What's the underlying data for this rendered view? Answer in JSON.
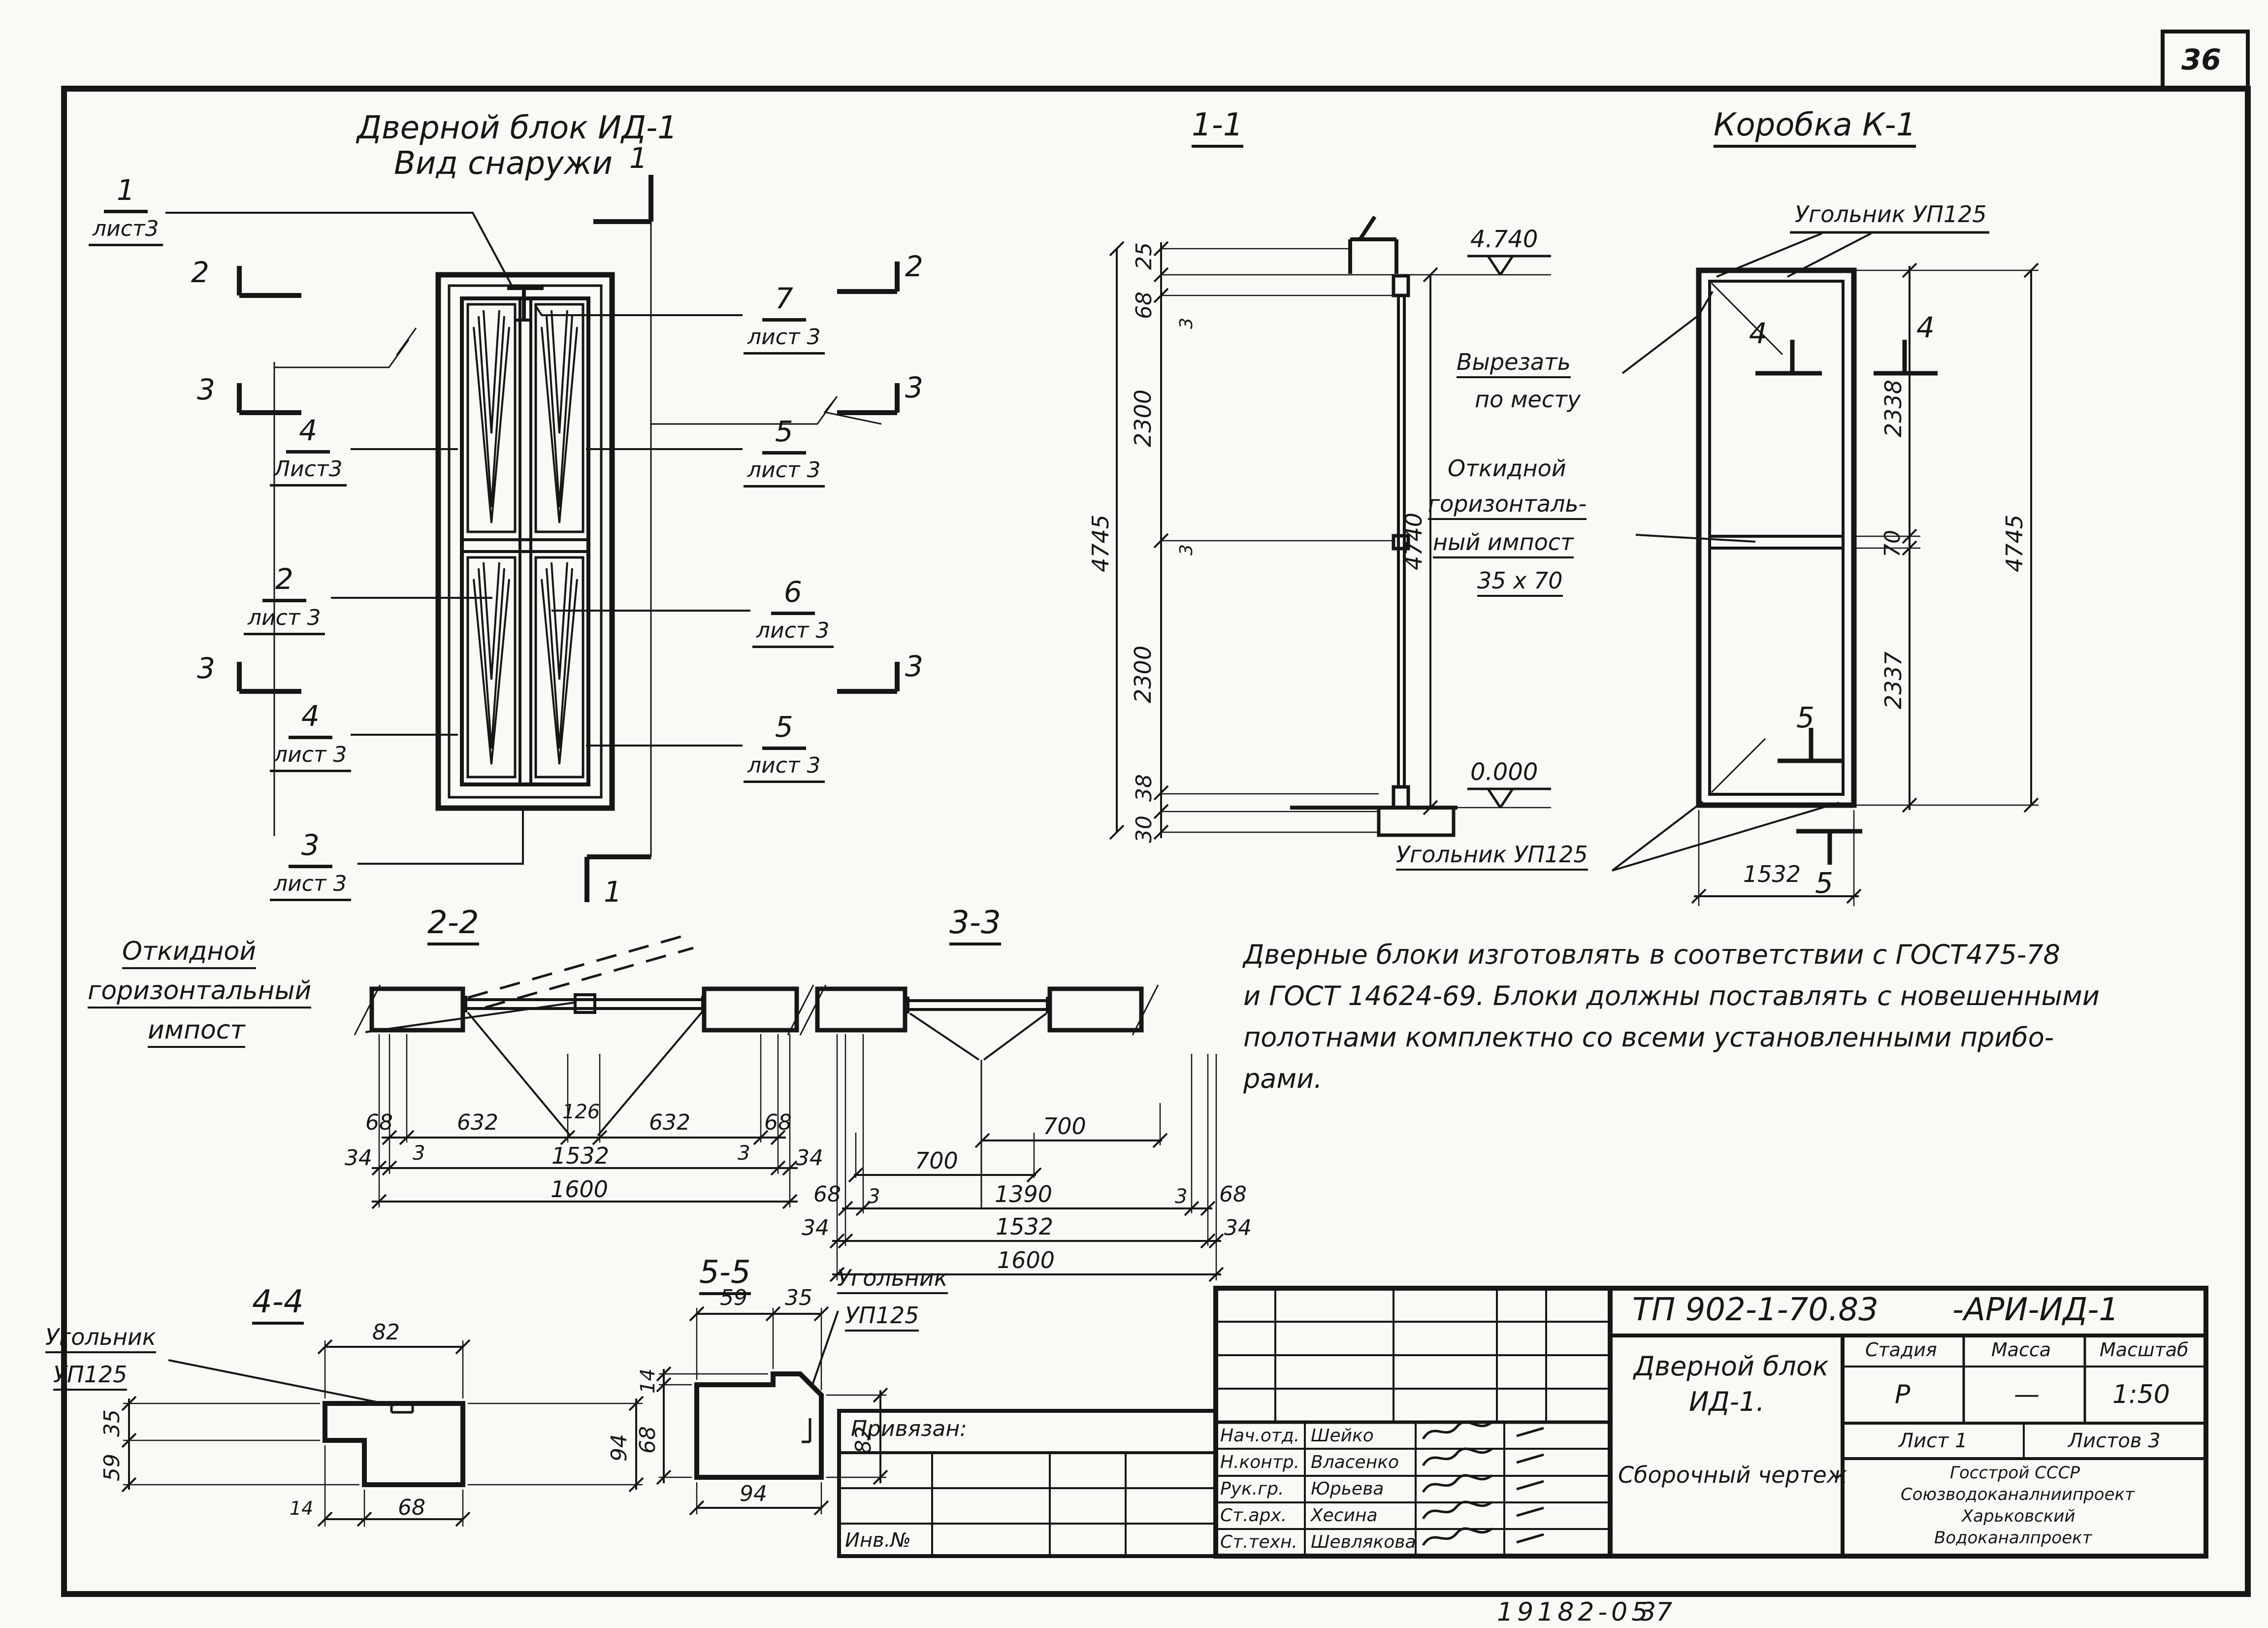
{
  "sheet": {
    "corner_number": "36",
    "footer_code": "19182-05",
    "footer_sheet": "37"
  },
  "elevation_view": {
    "title_line1": "Дверной блок ИД-1",
    "title_line2": "Вид снаружи",
    "callout_1": {
      "num": "1",
      "sheet": "лист3"
    },
    "callout_7": {
      "num": "7",
      "sheet": "лист 3"
    },
    "callout_4a": {
      "num": "4",
      "sheet": "Лист3"
    },
    "callout_5a": {
      "num": "5",
      "sheet": "лист 3"
    },
    "callout_2": {
      "num": "2",
      "sheet": "лист 3"
    },
    "callout_6": {
      "num": "6",
      "sheet": "лист 3"
    },
    "callout_4b": {
      "num": "4",
      "sheet": "лист 3"
    },
    "callout_5b": {
      "num": "5",
      "sheet": "лист 3"
    },
    "callout_3": {
      "num": "3",
      "sheet": "лист 3"
    },
    "marker_1_top": "1",
    "marker_1_bottom": "1",
    "marker_2_left": "2",
    "marker_2_right": "2",
    "marker_3_left_a": "3",
    "marker_3_right_a": "3",
    "marker_3_left_b": "3",
    "marker_3_right_b": "3"
  },
  "section_1_1": {
    "title": "1-1",
    "elev_top": "4.740",
    "elev_bottom": "0.000",
    "dim_25": "25",
    "dim_68": "68",
    "dim_3a": "3",
    "dim_2300a": "2300",
    "dim_3b": "3",
    "dim_2300b": "2300",
    "dim_38": "38",
    "dim_30": "30",
    "total_left": "4745",
    "total_right": "4740"
  },
  "korobka_view": {
    "title": "Коробка К-1",
    "label_ugolnik_top": "Угольник УП125",
    "label_cut_line1": "Вырезать",
    "label_cut_line2": "по месту",
    "label_impost_line1": "Откидной",
    "label_impost_line2": "горизонталь-",
    "label_impost_line3": "ный импост",
    "label_impost_line4": "35 x 70",
    "label_ugolnik_bottom": "Угольник УП125",
    "dim_2338": "2338",
    "dim_70": "70",
    "dim_2337": "2337",
    "total_right": "4745",
    "dim_width": "1532",
    "marker_4_left": "4",
    "marker_4_right": "4",
    "marker_5_top": "5",
    "marker_5_bottom": "5"
  },
  "note": {
    "line1": "Дверные блоки изготовлять в соответствии с ГОСТ475-78",
    "line2": "и ГОСТ 14624-69. Блоки должны поставлять с новешенными",
    "line3": "полотнами комплектно со всеми установленными прибо-",
    "line4": "рами."
  },
  "section_2_2": {
    "title": "2-2",
    "label_line1": "Откидной",
    "label_line2": "горизонтальный",
    "label_line3": "импост",
    "dims_row1": [
      "68",
      "632",
      "126",
      "632",
      "68"
    ],
    "dims_row2": [
      "34",
      "3",
      "1532",
      "3",
      "34"
    ],
    "dim_total": "1600"
  },
  "section_3_3": {
    "title": "3-3",
    "dim_700_right": "700",
    "dim_700_left": "700",
    "dims_row1": [
      "68",
      "3",
      "1390",
      "3",
      "68"
    ],
    "dims_row2": [
      "34",
      "1532",
      "34"
    ],
    "dim_total": "1600"
  },
  "section_4_4": {
    "title": "4-4",
    "label_line1": "Угольник",
    "label_line2": "УП125",
    "dim_top": "82",
    "dim_left_top": "35",
    "dim_left_bottom": "59",
    "dim_right": "94",
    "dim_bottom_small": "14",
    "dim_bottom": "68"
  },
  "section_5_5": {
    "title": "5-5",
    "label_line1": "Угольник",
    "label_line2": "УП125",
    "dim_top_left": "59",
    "dim_top_right": "35",
    "dim_left_top": "14",
    "dim_left_bottom": "68",
    "dim_right": "82",
    "dim_bottom": "94"
  },
  "title_block": {
    "doc_number": "ТП 902-1-70.83",
    "doc_suffix": "-АРИ-ИД-1",
    "binding_label": "Привязан:",
    "inventory_label": "Инв.№",
    "signatures": [
      {
        "role": "Нач.отд.",
        "name": "Шейко"
      },
      {
        "role": "Н.контр.",
        "name": "Власенко"
      },
      {
        "role": "Рук.гр.",
        "name": "Юрьева"
      },
      {
        "role": "Ст.арх.",
        "name": "Хесина"
      },
      {
        "role": "Ст.техн.",
        "name": "Шевлякова"
      }
    ],
    "title_line1": "Дверной блок",
    "title_line2": "ИД-1.",
    "title_line3": "Сборочный чертеж",
    "stage_label": "Стадия",
    "mass_label": "Масса",
    "scale_label": "Масштаб",
    "stage_value": "Р",
    "mass_value": "—",
    "scale_value": "1:50",
    "sheet_cell": "Лист 1",
    "sheets_cell": "Листов 3",
    "org_line1": "Госстрой СССР",
    "org_line2": "Союзводоканалниипроект",
    "org_line3": "Харьковский",
    "org_line4": "Водоканалпроект"
  }
}
